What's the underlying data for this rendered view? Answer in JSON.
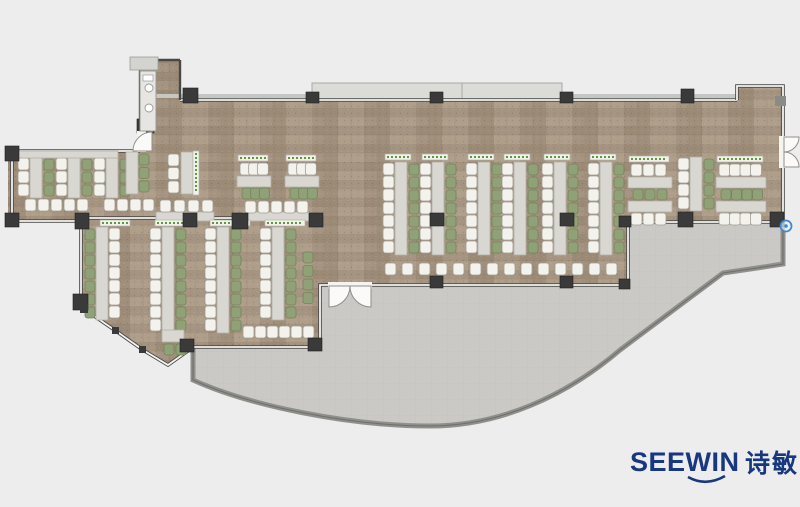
{
  "logo": {
    "latin": "SEEWIN",
    "cjk": "诗敏",
    "color": "#17377f"
  },
  "colors": {
    "bg": "#ededee",
    "wood": "#a59481",
    "woodDark": "#9b8a76",
    "woodLight": "#b0a08c",
    "woodSeam": "#8f7f6c",
    "terrace": "#cac9c5",
    "terraceLine": "#c0bfbb",
    "terraceWall": "#8f8f8b",
    "wall": "#484846",
    "winGap": "#f5f4f1",
    "winCore": "#9a9a96",
    "column": "#3a3a3a",
    "columnEdge": "#1f1f1f",
    "cornerGray": "#8a8a86",
    "table": "#d9d7d1",
    "tableEdge": "#b2afa7",
    "chairWhite": "#f4f2ed",
    "chairWhiteEdge": "#a09c93",
    "chairGreen": "#90a077",
    "chairGreenEdge": "#74845b",
    "planterBg": "#f3f3ed",
    "planterEdge": "#b5b2aa",
    "planterDot": "#4c8f2e",
    "canopy": "#dbdbd7",
    "canopyEdge": "#a9a9a5",
    "ledge": "#c6c6c2",
    "doorFill": "#fbfaf8",
    "doorEdge": "#8f8f8b",
    "counter": "#e6e5e1",
    "counterEdge": "#9a9a96",
    "stub": "#d3d3cf",
    "hotspot": "#4488cc"
  },
  "floorplan": {
    "canvas": {
      "w": 800,
      "h": 507
    },
    "wood_path": "M8,150 L140,150 L140,60 L180,60 L180,100 L737,100 L737,86 L783,86 L783,222 L628,222 L628,285 L320,285 L320,347 L192,347 L168,365 L84,309 L81,297 L81,221 L8,221 Z",
    "terrace_path": "M193,347 L320,347 L320,285 L628,285 L628,222 L783,222 L783,264 L757,268 L723,273 L620,350 C566,396 500,426 430,426 C350,426 250,406 193,380 Z",
    "terrace_wall": "M193,348 L193,380 C250,406 350,426 430,426 C500,426 566,396 620,350 L723,273 L757,268 L783,264 L783,223",
    "canopy": {
      "x": 312,
      "y": 83,
      "w": 250,
      "h": 16,
      "seam": 462
    },
    "ledges": [
      [
        150,
        94,
        162,
        4
      ],
      [
        562,
        94,
        176,
        4
      ]
    ],
    "walls_solid": [
      "M140,60 L180,60",
      "M140,60 L140,132",
      "M180,60 L180,100"
    ],
    "walls_window": [
      "M8,151 L140,151",
      "M12,151 L12,221",
      "M12,221 L81,221",
      "M81,222 L81,297",
      "M81,297 L84,309 L116,331 L143,350 L168,365 L192,348",
      "M88,218 L316,218",
      "M180,100 L737,100",
      "M737,100 L737,86 L783,86 L783,137",
      "M783,167 L783,223",
      "M783,222 L628,222",
      "M628,222 L628,285",
      "M628,285 L372,285",
      "M328,285 L320,285 L320,347 L193,347"
    ],
    "door_gaps": [
      [
        779,
        136,
        10,
        32
      ],
      [
        328,
        282,
        44,
        7
      ],
      [
        137,
        131,
        9,
        21
      ]
    ],
    "door_fans": [
      "M784,137 L799,137 A15,15 0 0 1 784,152 Z",
      "M784,167 L799,167 A15,15 0 0 0 784,152 Z",
      "M329,286 L329,307 A21,21 0 0 0 350,286 Z",
      "M371,286 L350,286 A21,21 0 0 0 371,307 Z",
      "M152,151 L133,151 A19,19 0 0 1 152,132 Z"
    ],
    "columns": [
      [
        5,
        146,
        14,
        15
      ],
      [
        5,
        213,
        14,
        14
      ],
      [
        75,
        213,
        14,
        16
      ],
      [
        73,
        294,
        15,
        16
      ],
      [
        180,
        339,
        14,
        13
      ],
      [
        308,
        338,
        14,
        13
      ],
      [
        183,
        213,
        14,
        14
      ],
      [
        232,
        213,
        16,
        16
      ],
      [
        309,
        213,
        14,
        14
      ],
      [
        430,
        213,
        14,
        13
      ],
      [
        560,
        213,
        14,
        13
      ],
      [
        619,
        216,
        12,
        11
      ],
      [
        678,
        212,
        15,
        15
      ],
      [
        770,
        212,
        14,
        15
      ],
      [
        430,
        276,
        13,
        12
      ],
      [
        560,
        276,
        13,
        12
      ],
      [
        619,
        279,
        11,
        10
      ],
      [
        183,
        88,
        15,
        15
      ],
      [
        306,
        92,
        13,
        11
      ],
      [
        430,
        92,
        13,
        11
      ],
      [
        560,
        92,
        13,
        11
      ],
      [
        681,
        89,
        13,
        14
      ],
      [
        137,
        119,
        17,
        14
      ]
    ],
    "facet_nodes": [
      [
        80,
        305,
        8,
        8
      ],
      [
        112,
        327,
        7,
        7
      ],
      [
        139,
        346,
        7,
        7
      ]
    ],
    "corner_markers": [
      [
        775,
        96,
        11,
        10
      ]
    ],
    "counter": {
      "x": 140,
      "y": 71,
      "w": 16,
      "h": 60,
      "fixtures": [
        [
          149,
          88
        ],
        [
          149,
          108
        ]
      ]
    },
    "stub": [
      130,
      57,
      28,
      13
    ],
    "hotspot": {
      "x": 786,
      "y": 226,
      "r": 5.5
    },
    "furniture": {
      "vstrips": [
        {
          "x": 18,
          "y": 158,
          "n": 3,
          "o": "wtg",
          "p": 0
        },
        {
          "x": 56,
          "y": 158,
          "n": 3,
          "o": "wtg",
          "p": 0
        },
        {
          "x": 94,
          "y": 158,
          "n": 3,
          "o": "wtg",
          "p": 0
        },
        {
          "x": 383,
          "y": 163,
          "n": 7,
          "o": "wtg",
          "p": 1
        },
        {
          "x": 420,
          "y": 163,
          "n": 7,
          "o": "wtg",
          "p": 1
        },
        {
          "x": 466,
          "y": 163,
          "n": 7,
          "o": "wtg",
          "p": 1
        },
        {
          "x": 502,
          "y": 163,
          "n": 7,
          "o": "wtg",
          "p": 1
        },
        {
          "x": 542,
          "y": 163,
          "n": 7,
          "o": "wtg",
          "p": 1
        },
        {
          "x": 588,
          "y": 163,
          "n": 7,
          "o": "wtg",
          "p": 1
        },
        {
          "x": 85,
          "y": 228,
          "n": 7,
          "o": "gtw",
          "p": 0
        },
        {
          "x": 150,
          "y": 228,
          "n": 8,
          "o": "wtg",
          "p": 0
        },
        {
          "x": 205,
          "y": 228,
          "n": 8,
          "o": "wtg",
          "p": 0
        },
        {
          "x": 260,
          "y": 228,
          "n": 7,
          "o": "wtg",
          "p": 0
        },
        {
          "x": 678,
          "y": 158,
          "n": 4,
          "o": "wtg",
          "p": 0
        }
      ],
      "banquettes": [
        {
          "x": 237,
          "w": 34,
          "y": 155,
          "n": 3,
          "rows": "pwtg"
        },
        {
          "x": 285,
          "w": 34,
          "y": 155,
          "n": 3,
          "rows": "pwtg"
        },
        {
          "x": 628,
          "w": 44,
          "y": 156,
          "n": 3,
          "rows": "pwtgtw"
        },
        {
          "x": 716,
          "w": 50,
          "y": 156,
          "n": 4,
          "rows": "pwtgtw"
        }
      ],
      "tablev": [
        {
          "x": 126,
          "y": 152,
          "h": 42
        },
        {
          "x": 181,
          "y": 152,
          "h": 42
        }
      ],
      "tableh": [
        {
          "x": 18,
          "y": 151,
          "w": 100,
          "h": 7
        },
        {
          "x": 156,
          "y": 212,
          "w": 58,
          "h": 9
        },
        {
          "x": 243,
          "y": 212,
          "w": 66,
          "h": 9
        },
        {
          "x": 162,
          "y": 330,
          "w": 22,
          "h": 12
        }
      ],
      "colchairs": [
        {
          "x": 139,
          "y": 154,
          "n": 3,
          "c": "g"
        },
        {
          "x": 168,
          "y": 154,
          "n": 3,
          "c": "w"
        },
        {
          "x": 303,
          "y": 252,
          "n": 4,
          "c": "g"
        }
      ],
      "rowchairs": [
        {
          "x": 25,
          "y": 199,
          "n": 5,
          "pitch": 13,
          "c": "w"
        },
        {
          "x": 104,
          "y": 199,
          "n": 4,
          "pitch": 13,
          "c": "w"
        },
        {
          "x": 160,
          "y": 200,
          "n": 4,
          "pitch": 14,
          "c": "w"
        },
        {
          "x": 245,
          "y": 201,
          "n": 5,
          "pitch": 13,
          "c": "w"
        },
        {
          "x": 385,
          "y": 263,
          "n": 14,
          "pitch": 17,
          "c": "w"
        },
        {
          "x": 243,
          "y": 326,
          "n": 6,
          "pitch": 12,
          "c": "w"
        },
        {
          "x": 164,
          "y": 344,
          "n": 2,
          "pitch": 12,
          "c": "g"
        }
      ],
      "planterh": [
        {
          "x": 100,
          "y": 220,
          "len": 30
        },
        {
          "x": 155,
          "y": 220,
          "len": 40
        },
        {
          "x": 210,
          "y": 220,
          "len": 40
        },
        {
          "x": 265,
          "y": 220,
          "len": 40
        }
      ],
      "planterv": [
        {
          "x": 193,
          "y": 151,
          "len": 44
        }
      ]
    }
  }
}
